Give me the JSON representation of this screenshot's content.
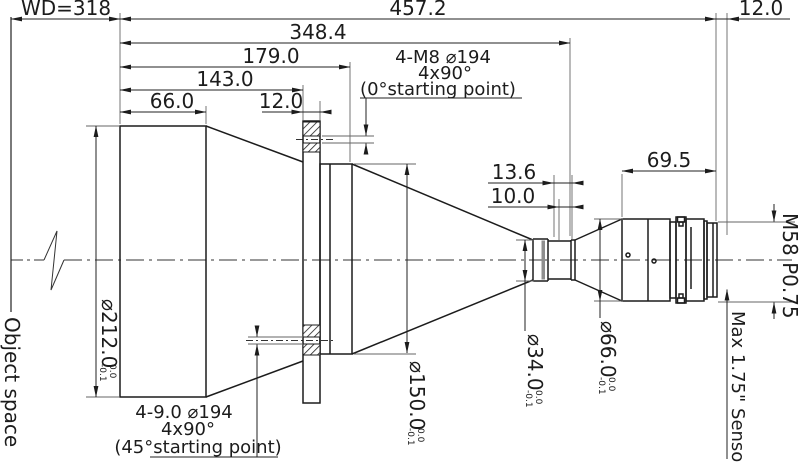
{
  "dims_top": {
    "wd": "WD=318",
    "overall": "457.2",
    "sensor_offset": "12.0",
    "l348": "348.4",
    "l179": "179.0",
    "l143": "143.0",
    "l66": "66.0",
    "flange_thickness": "12.0"
  },
  "dims_mid": {
    "d136": "13.6",
    "d100": "10.0",
    "rear_length": "69.5"
  },
  "callout_front_holes": {
    "l1": "4-M8 ⌀194",
    "l2": "4x90°",
    "l3": "(0°starting point)"
  },
  "callout_back_holes": {
    "l1": "4-9.0 ⌀194",
    "l2": "4x90°",
    "l3": "(45°starting point)"
  },
  "diameters": {
    "d212": {
      "v": "⌀212.0",
      "tu": "0.0",
      "tl": "-0.1"
    },
    "d150": {
      "v": "⌀150.0",
      "tu": "0.0",
      "tl": "-0.1"
    },
    "d34": {
      "v": "⌀34.0",
      "tu": "0.0",
      "tl": "-0.1"
    },
    "d66": {
      "v": "⌀66.0",
      "tu": "0.0",
      "tl": "-0.1"
    }
  },
  "labels": {
    "object_space": "Object space",
    "thread": "M58 P0.75",
    "sensor": "Max 1.75\" Sensor"
  },
  "colors": {
    "line": "#1c1c1c",
    "ext": "#666666",
    "band": "#8f8f8f",
    "bg": "#ffffff"
  }
}
